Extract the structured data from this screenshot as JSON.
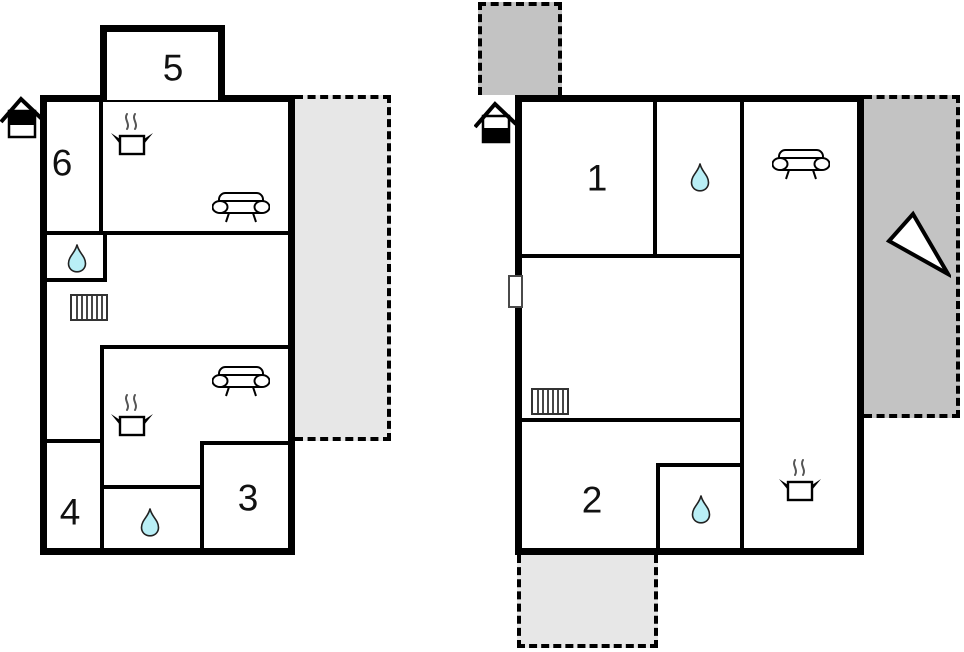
{
  "page": {
    "title": "Holiday home floor plan",
    "type": "floor-plan-diagram"
  },
  "colors": {
    "wall": "#000000",
    "terrace_light": "#e7e7e7",
    "terrace_dark": "#c3c3c3",
    "water_drop": "#b9eff6",
    "background": "#ffffff"
  },
  "plans": {
    "left": {
      "floor_indicator": "house-icon-top-half-filled",
      "rooms": {
        "annex": "5",
        "upper_left": "6",
        "lower_left": "4",
        "lower_right": "3"
      },
      "features": [
        "kitchen-stove",
        "sofa",
        "water-drop",
        "stairs",
        "sofa",
        "kitchen-stove",
        "water-drop"
      ],
      "terraces": [
        "dashed-light-gray-right"
      ]
    },
    "right": {
      "floor_indicator": "house-icon-bottom-half-filled",
      "rooms": {
        "upper": "1",
        "lower": "2"
      },
      "features": [
        "water-drop",
        "sofa",
        "window",
        "stairs",
        "water-drop",
        "kitchen-stove",
        "north-arrow"
      ],
      "terraces": [
        "dashed-dark-gray-top",
        "dashed-dark-gray-right",
        "dashed-light-gray-bottom"
      ]
    }
  }
}
